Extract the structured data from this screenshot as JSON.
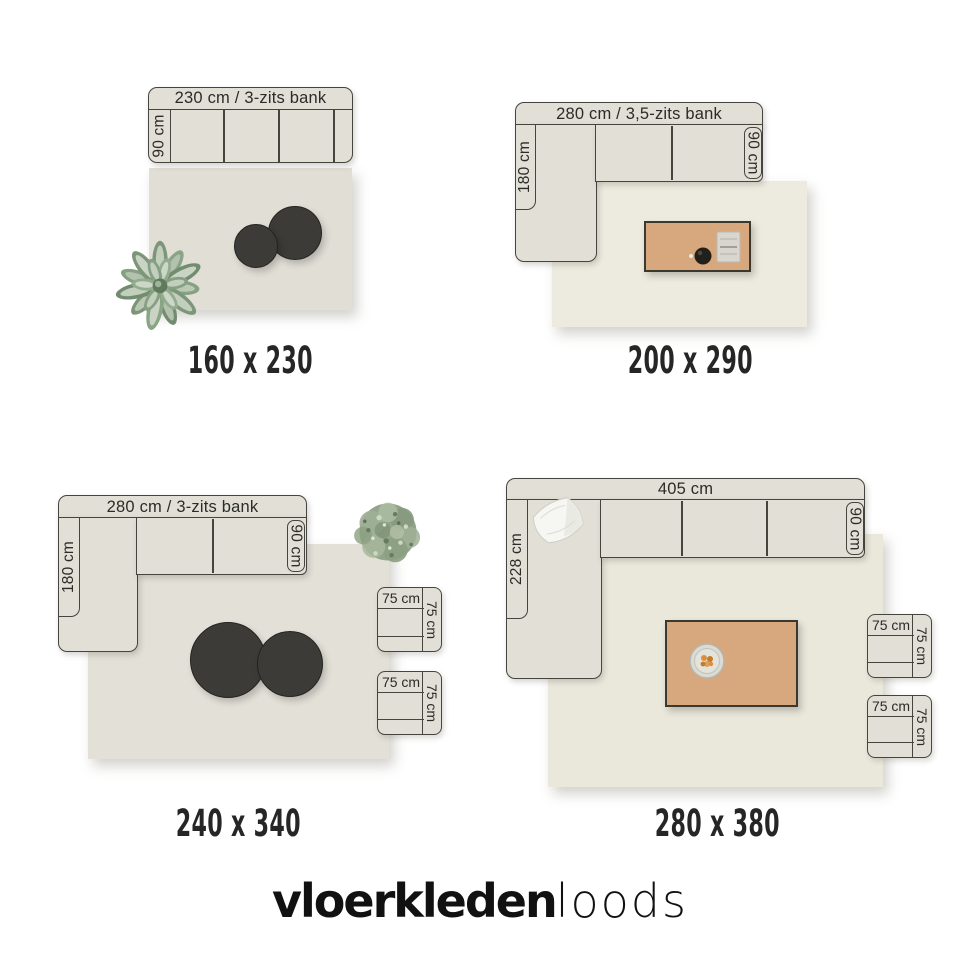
{
  "logo": {
    "bold": "vloerkleden",
    "light": "loods"
  },
  "colors": {
    "outline": "#45443f",
    "sofa_fill": "#e2dfd7",
    "rug_fill_small": "#e1ded5",
    "rug_fill_cream": "#edebdf",
    "table_fill": "#d7a77d",
    "pouf_fill": "#3c3b37",
    "text": "#2b2b28"
  },
  "quadrants": [
    {
      "id": "rug-160x230",
      "rug_size": "160 x 230",
      "sofa_width_label": "230 cm / 3-zits bank",
      "sofa_depth_label": "90 cm"
    },
    {
      "id": "rug-200x290",
      "rug_size": "200 x 290",
      "sofa_width_label": "280 cm / 3,5-zits bank",
      "chaise_depth_label": "180 cm",
      "sofa_depth_label": "90 cm"
    },
    {
      "id": "rug-240x340",
      "rug_size": "240 x 340",
      "sofa_width_label": "280 cm / 3-zits bank",
      "chaise_depth_label": "180 cm",
      "sofa_depth_label": "90 cm",
      "chair_width_label": "75 cm",
      "chair_depth_label": "75 cm"
    },
    {
      "id": "rug-280x380",
      "rug_size": "280 x 380",
      "sofa_width_label": "405 cm",
      "chaise_depth_label": "228 cm",
      "sofa_depth_label": "90 cm",
      "chair_width_label": "75 cm",
      "chair_depth_label": "75 cm"
    }
  ]
}
